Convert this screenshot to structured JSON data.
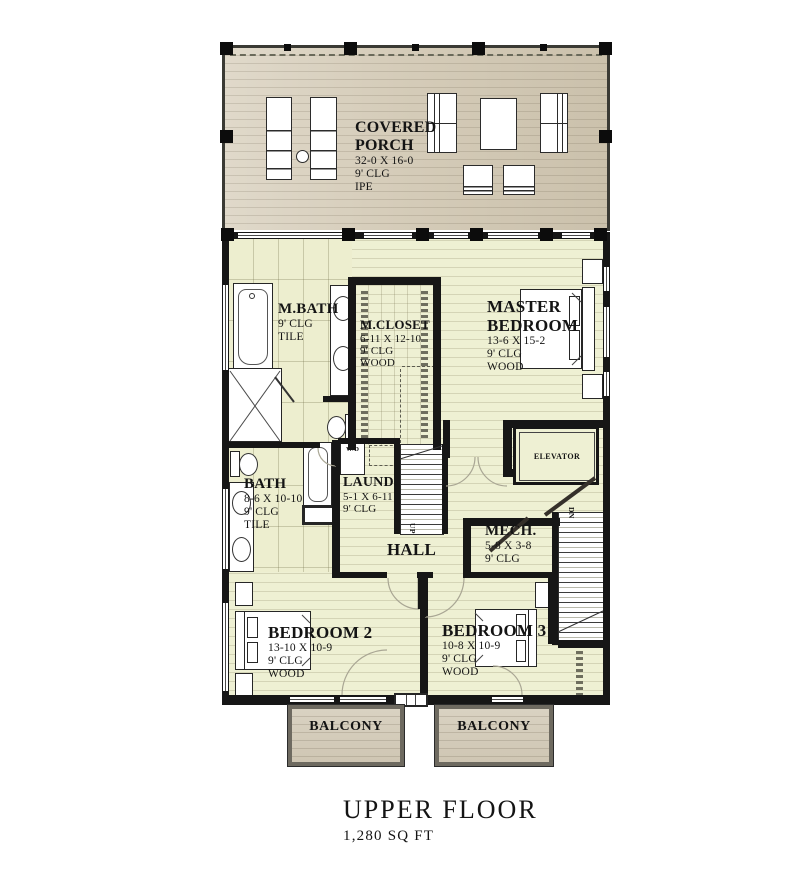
{
  "plan": {
    "rooms": {
      "covered_porch": {
        "name_line1": "COVERED",
        "name_line2": "PORCH",
        "dims": "32-0 X 16-0",
        "clg": "9' CLG",
        "floor": "IPE"
      },
      "master_bath": {
        "name": "M.BATH",
        "clg": "9' CLG",
        "floor": "TILE"
      },
      "master_closet": {
        "name": "M.CLOSET",
        "dims": "6-11 X 12-10",
        "clg": "9' CLG",
        "floor": "WOOD"
      },
      "master_bedroom": {
        "name_line1": "MASTER",
        "name_line2": "BEDROOM",
        "dims": "13-6 X 15-2",
        "clg": "9' CLG",
        "floor": "WOOD"
      },
      "bath": {
        "name": "BATH",
        "dims": "8-6 X 10-10",
        "clg": "9' CLG",
        "floor": "TILE"
      },
      "laundry": {
        "name": "LAUND.",
        "dims": "5-1 X 6-11",
        "clg": "9' CLG"
      },
      "hall": {
        "name": "HALL"
      },
      "mech": {
        "name": "MECH.",
        "dims": "5-8 X 3-8",
        "clg": "9' CLG"
      },
      "elevator": {
        "name": "ELEVATOR"
      },
      "bedroom_2": {
        "name": "BEDROOM 2",
        "dims": "13-10 X 10-9",
        "clg": "9' CLG",
        "floor": "WOOD"
      },
      "bedroom_3": {
        "name": "BEDROOM 3",
        "dims": "10-8 X 10-9",
        "clg": "9' CLG",
        "floor": "WOOD"
      },
      "balcony_left": {
        "name": "BALCONY"
      },
      "balcony_right": {
        "name": "BALCONY"
      }
    },
    "annotations": {
      "stairs_up": "UP",
      "stairs_down": "DN",
      "washer_dryer": "W/D"
    },
    "colors": {
      "floor": "#eef0d3",
      "porch_deck": "#d5ccb9",
      "wall": "#161616",
      "tile": "#edeecf"
    }
  },
  "title": {
    "text": "UPPER FLOOR",
    "area": "1,280 SQ FT"
  }
}
